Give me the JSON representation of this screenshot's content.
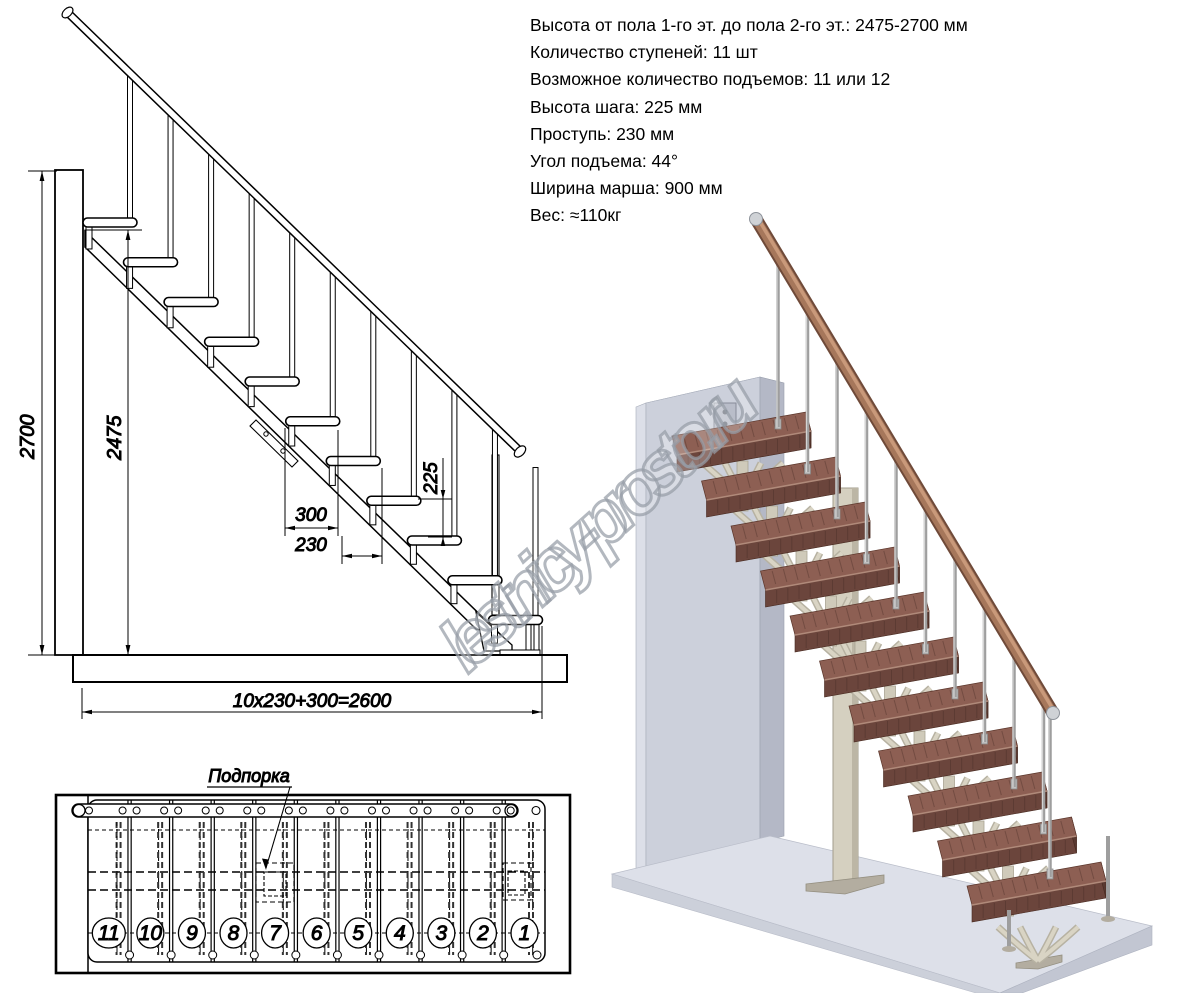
{
  "specs": {
    "lines": [
      "Высота от пола 1-го эт. до пола 2-го эт.: 2475-2700 мм",
      "Количество ступеней: 11 шт",
      "Возможное количество подъемов: 11 или 12",
      "Высота шага: 225 мм",
      "Проступь: 230 мм",
      "Угол подъема: 44°",
      "Ширина марша: 900 мм",
      "Вес: ≈110кг"
    ]
  },
  "elevation": {
    "dims": {
      "total_height": "2700",
      "flight_height": "2475",
      "overhang": "300",
      "tread": "230",
      "rise": "225",
      "run_formula": "10x230+300=2600"
    }
  },
  "plan": {
    "support_label": "Подпорка",
    "step_numbers": [
      "11",
      "10",
      "9",
      "8",
      "7",
      "6",
      "5",
      "4",
      "3",
      "2",
      "1"
    ]
  },
  "watermark": "lestnicy-prosto.ru",
  "colors": {
    "line": "#000000",
    "step_top": "#8d5f53",
    "step_front": "#6b453c",
    "step_side": "#593931",
    "step_edge": "#b08a7a",
    "rail_dark": "#6f4a39",
    "rail_mid": "#a6775b",
    "rail_light": "#c9997a",
    "metal": "#9e9e9e",
    "metal_light": "#d4d4d4",
    "support_beam": "#cfcaba",
    "support_dark": "#b7b2a2",
    "support_light": "#d9d4c4",
    "wall_front": "#ccd0db",
    "wall_top": "#e6e8ef",
    "wall_side": "#b4b8c6",
    "floor_top": "#dde0e9",
    "floor_front": "#ccd0da",
    "floor_side": "#c2c6d2",
    "plate": "#b3ada0",
    "watermark": "#969ca6"
  }
}
